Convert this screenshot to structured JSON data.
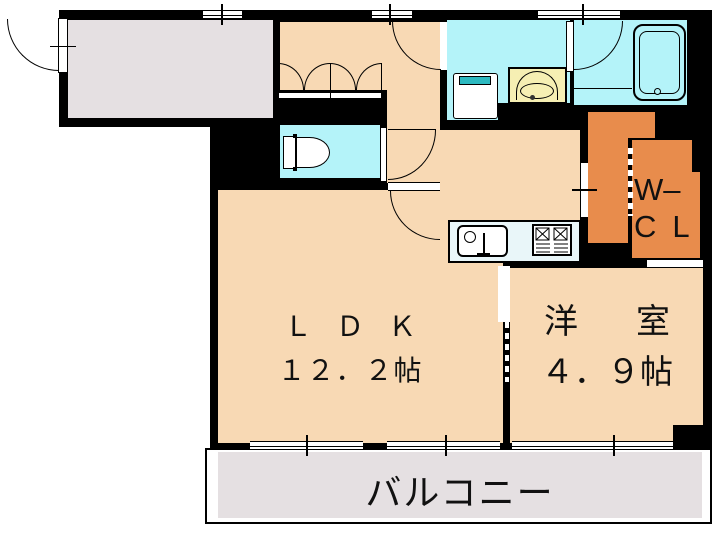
{
  "rooms": {
    "ldk": {
      "label": "ＬＤＫ",
      "area": "１２．２帖"
    },
    "western_room": {
      "label": "洋　室",
      "area": "４．９帖"
    },
    "walk_in_closet": {
      "line1": "W–",
      "line2": "CL"
    },
    "balcony": {
      "label": "バルコニー"
    }
  },
  "fixtures": {
    "toilet": "toilet",
    "bathtub": "bathtub",
    "washing_machine": "washing-machine-pan",
    "vanity": "vanity-basin",
    "kitchen_sink": "kitchen-sink",
    "stove": "gas-stove"
  },
  "colors": {
    "wall": "#000000",
    "floor": "#f8d9b4",
    "closet": "#e88c4c",
    "wet": "#b4f3f9",
    "vanity": "#f6efb3",
    "gray": "#e5e0e2",
    "counter": "#e9f6f9",
    "teal": "#2cb9c0"
  }
}
